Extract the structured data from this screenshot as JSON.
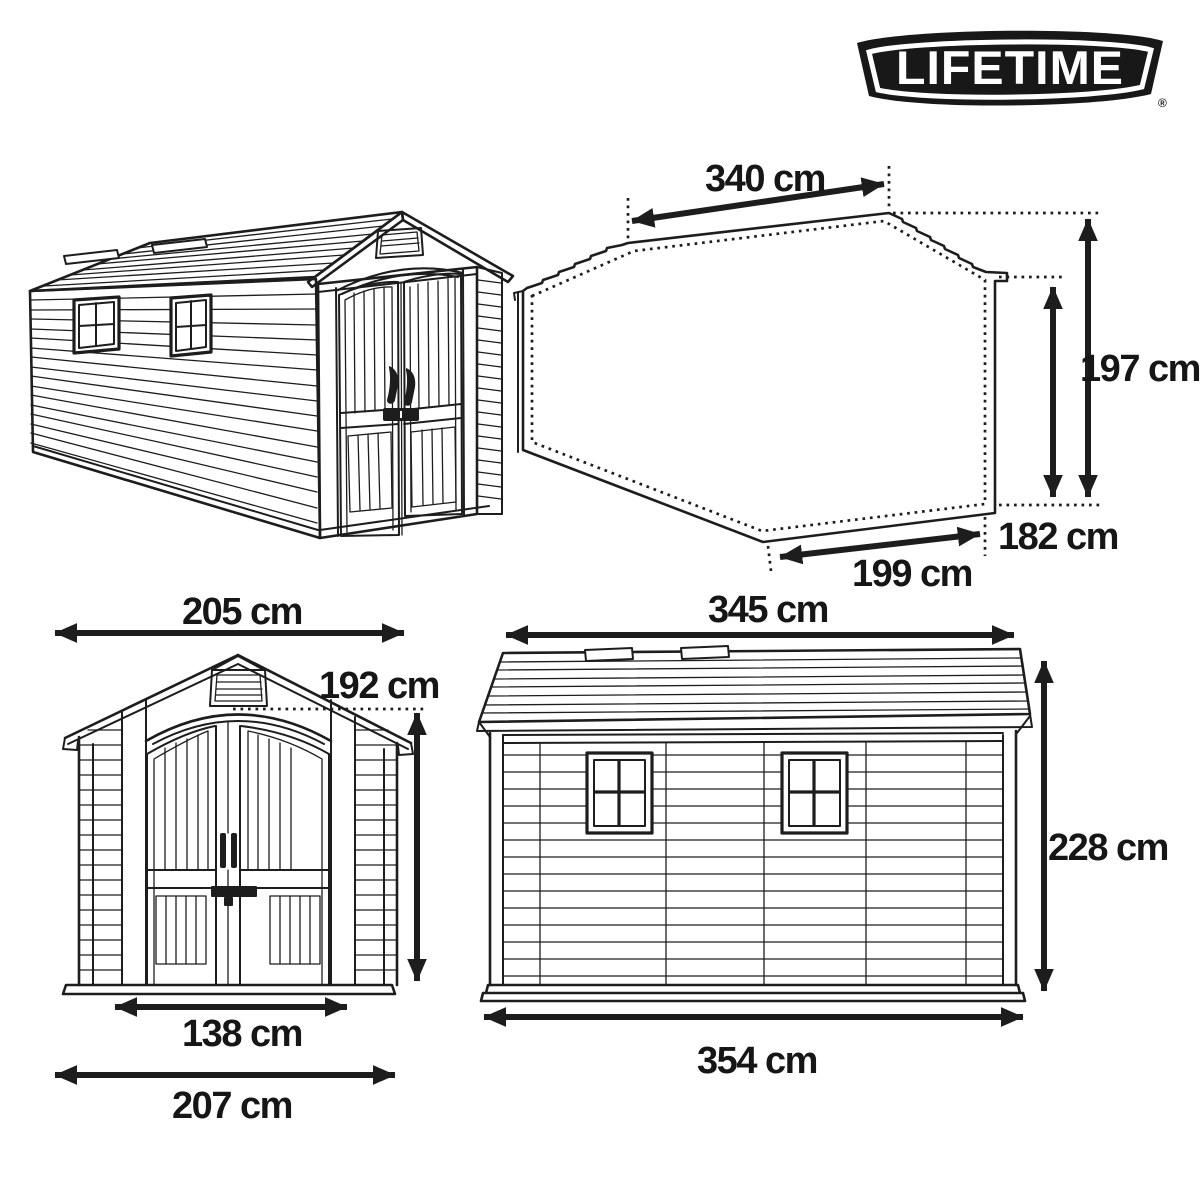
{
  "brand": {
    "name": "LIFETIME",
    "registered": "®"
  },
  "units": "cm",
  "views": {
    "footprint": {
      "width_top": "340 cm",
      "height_total": "197 cm",
      "height_eave": "182 cm",
      "width_bottom": "199 cm"
    },
    "front": {
      "width_roof": "205 cm",
      "height_eave": "192 cm",
      "width_door": "138 cm",
      "width_base": "207 cm"
    },
    "side": {
      "width_roof": "345 cm",
      "height_total": "228 cm",
      "width_base": "354 cm"
    }
  },
  "colors": {
    "ink": "#1d1d1d",
    "background": "#ffffff",
    "logo_bg": "#181818",
    "logo_fg": "#ffffff"
  }
}
